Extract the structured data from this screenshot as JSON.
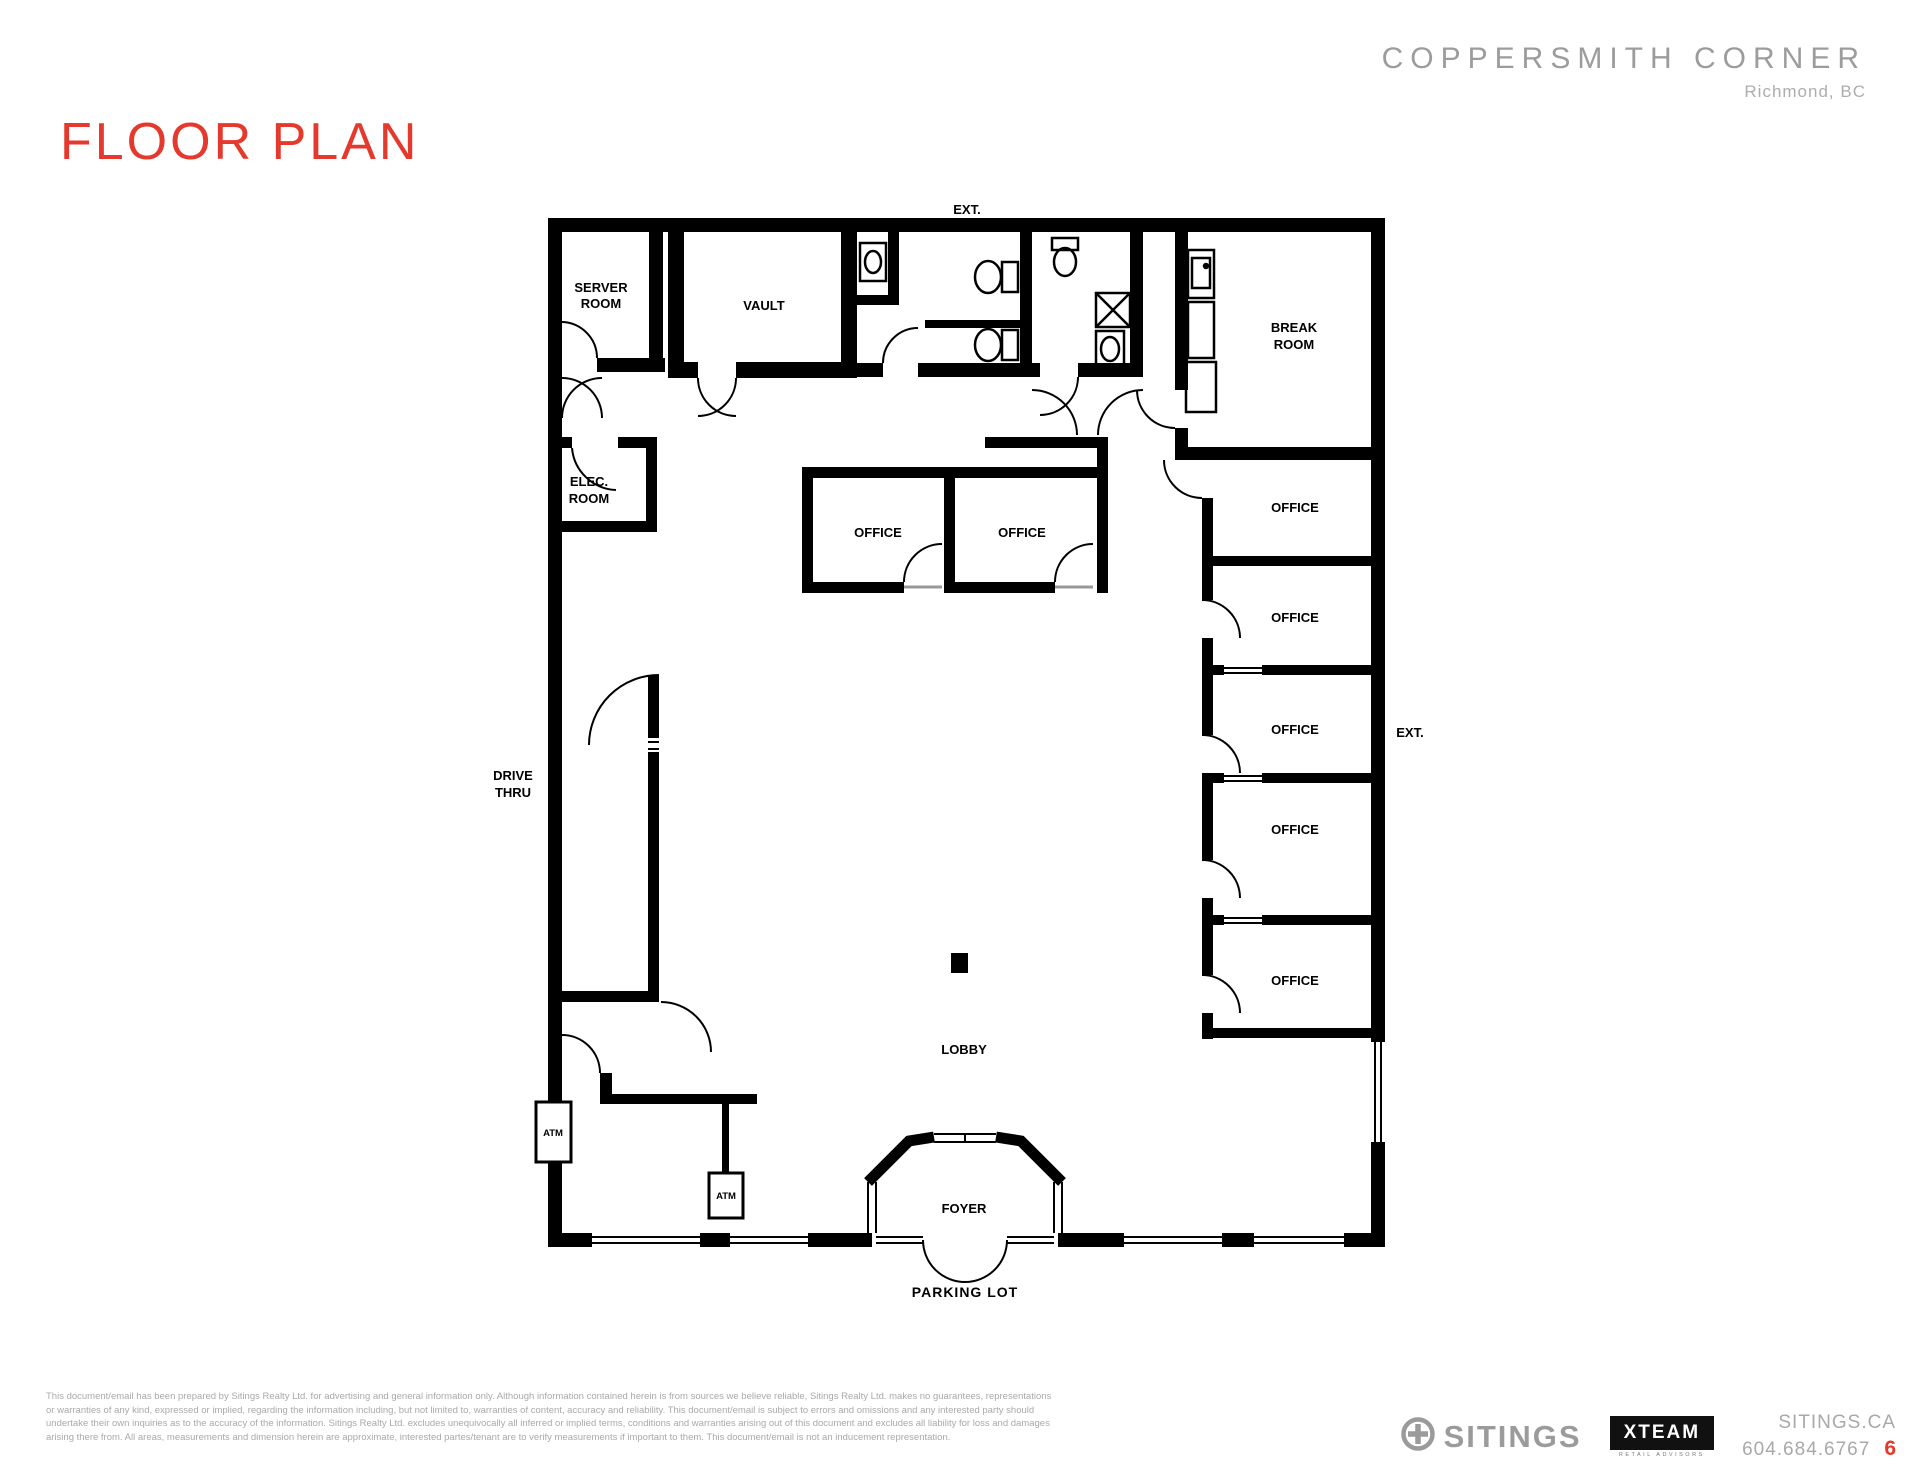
{
  "page": {
    "title": "FLOOR PLAN",
    "project_name": "COPPERSMITH CORNER",
    "project_location": "Richmond, BC",
    "page_number": "6"
  },
  "colors": {
    "accent_red": "#E5392D",
    "header_gray": "#9C9C9C",
    "footer_gray": "#A9A9A9",
    "wall_black": "#000000"
  },
  "floorplan": {
    "labels": {
      "ext_top": "EXT.",
      "ext_right": "EXT.",
      "server_room_1": "SERVER",
      "server_room_2": "ROOM",
      "vault": "VAULT",
      "break_room_1": "BREAK",
      "break_room_2": "ROOM",
      "elec_room_1": "ELEC.",
      "elec_room_2": "ROOM",
      "office_mid_left": "OFFICE",
      "office_mid_right": "OFFICE",
      "office_right_1": "OFFICE",
      "office_right_2": "OFFICE",
      "office_right_3": "OFFICE",
      "office_right_4": "OFFICE",
      "office_right_5": "OFFICE",
      "drive_thru_1": "DRIVE",
      "drive_thru_2": "THRU",
      "atm_left": "ATM",
      "atm_lobby": "ATM",
      "lobby": "LOBBY",
      "foyer": "FOYER",
      "parking_lot": "PARKING LOT"
    }
  },
  "footer": {
    "disclaimer": [
      "This document/email has been prepared by Sitings Realty Ltd. for advertising and general information only. Although information contained herein is from sources we believe reliable, Sitings Realty Ltd. makes no guarantees, representations",
      "or warranties of any kind, expressed or implied, regarding the information including, but not limited to, warranties of content, accuracy and reliability. This document/email is subject to errors and omissions and any interested party should",
      "undertake their own inquiries as to the accuracy of the information. Sitings Realty Ltd. excludes unequivocally all inferred or implied terms, conditions and warranties arising out of this document and excludes all liability for loss and damages",
      "arising there from. All areas, measurements and dimension herein are approximate, interested partes/tenant are to verify measurements if important to them. This document/email is not an inducement representation."
    ],
    "sitings_wordmark": "SITINGS",
    "xteam_wordmark": "XTEAM",
    "xteam_tagline": "RETAIL ADVISORS",
    "website": "SITINGS.CA",
    "phone": "604.684.6767"
  }
}
